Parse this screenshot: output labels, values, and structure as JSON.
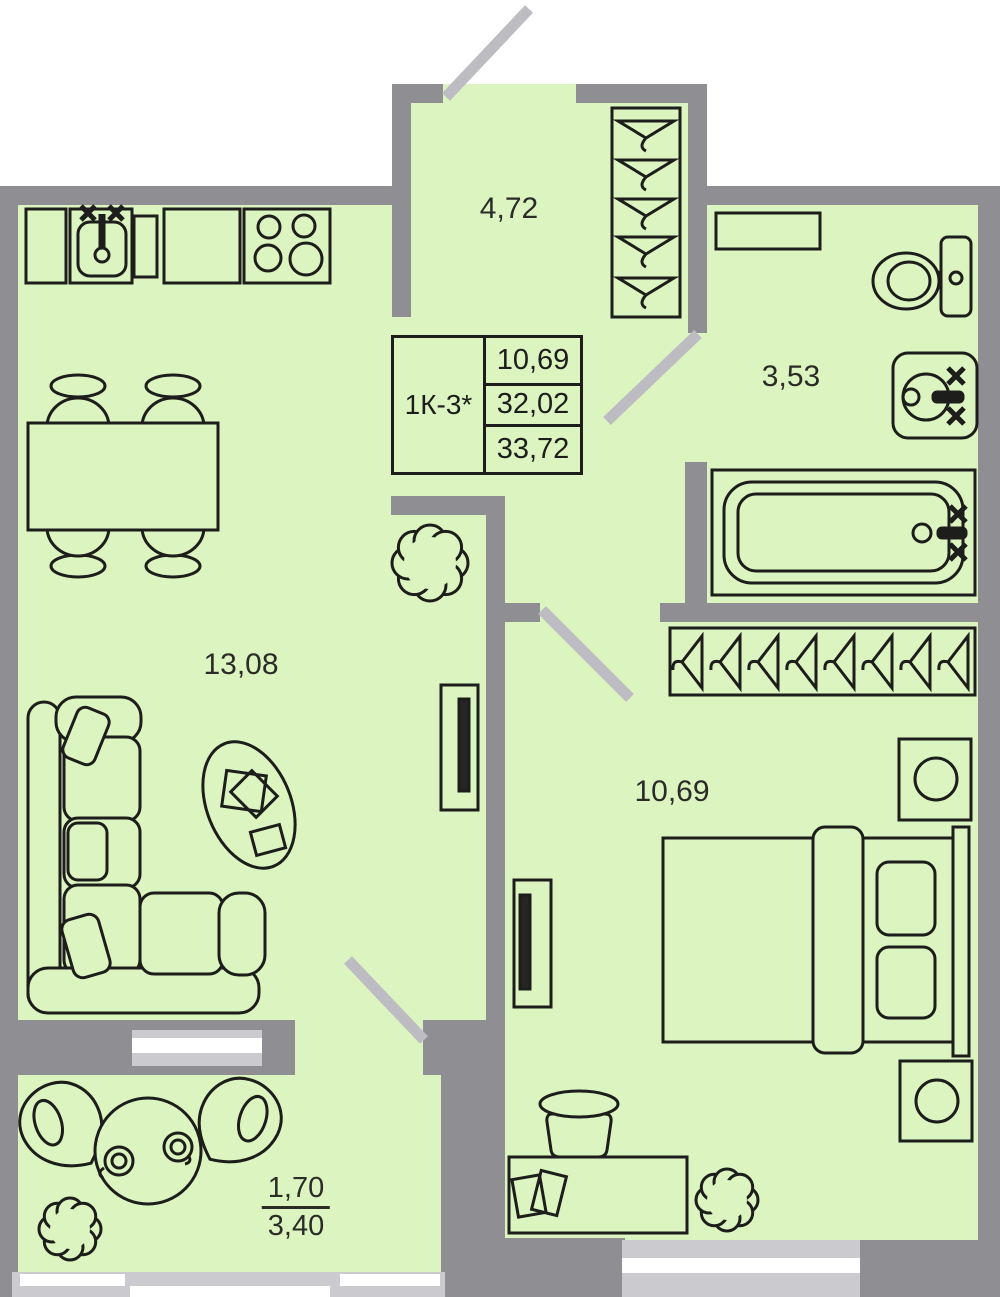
{
  "title_block": {
    "code": "1К-3*",
    "rows": [
      "10,69",
      "32,02",
      "33,72"
    ]
  },
  "rooms": {
    "hallway": {
      "label": "4,72"
    },
    "bathroom": {
      "label": "3,53"
    },
    "living": {
      "label": "13,08"
    },
    "bedroom": {
      "label": "10,69"
    },
    "balcony": {
      "coefficient_area": "1,70",
      "full_area": "3,40"
    }
  },
  "colors": {
    "floor": "#dcf5c0",
    "wall": "#8f8f93",
    "door_leaf": "#bcbcc2",
    "window_frame": "#cbcbcf",
    "glass": "#ffffff",
    "outline": "#1d1d1b"
  },
  "symbols": {
    "kitchen": [
      "base-cabinet",
      "sink-unit",
      "narrow-cabinet",
      "counter",
      "stove-4-burner"
    ],
    "living": [
      "dining-table-4-chairs",
      "corner-sofa",
      "coffee-table",
      "plant",
      "cabinet-panel"
    ],
    "hallway": [
      "wardrobe-5-hangers",
      "entry-door"
    ],
    "bathroom": [
      "shelf",
      "toilet",
      "washbasin",
      "bathtub",
      "door"
    ],
    "bedroom": [
      "wardrobe-8-hangers",
      "double-bed",
      "nightstand",
      "nightstand",
      "desk",
      "desk-chair",
      "plant",
      "cabinet-panel",
      "door"
    ],
    "balcony": [
      "round-table",
      "cup",
      "cup",
      "armchair",
      "armchair",
      "plant",
      "balcony-door",
      "railing-windows"
    ]
  }
}
